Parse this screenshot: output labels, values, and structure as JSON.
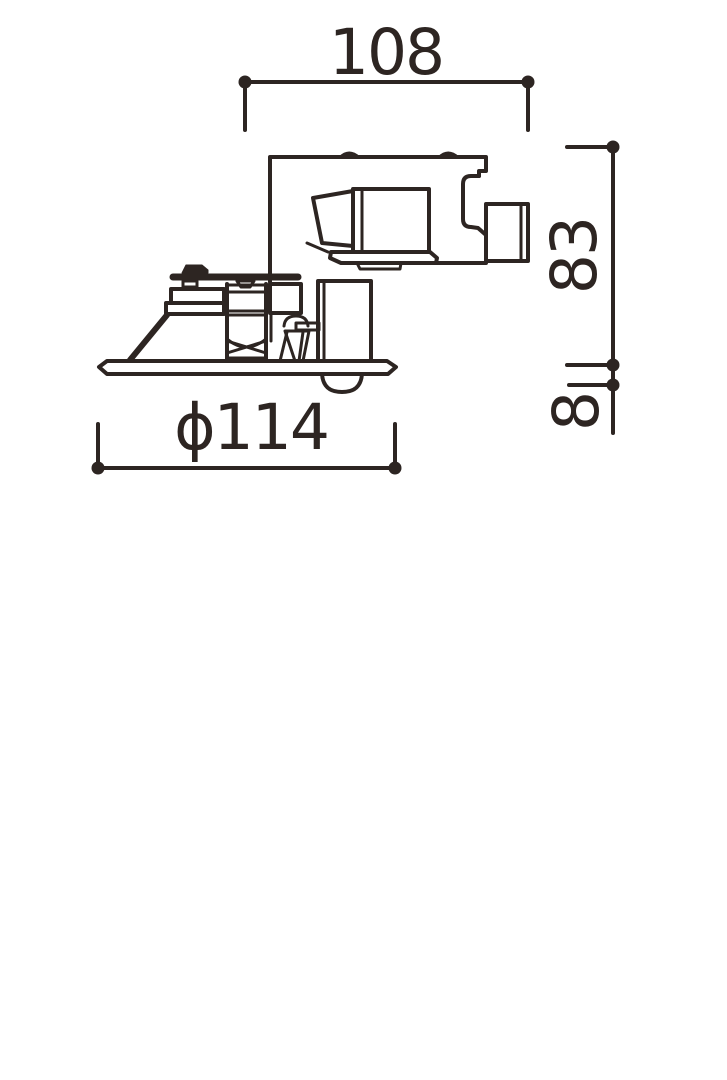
{
  "figure": {
    "type": "technical-dimension-drawing",
    "subject": "recessed downlight fixture side view",
    "ink_color": "#2d2522",
    "background_color": "#ffffff"
  },
  "dimensions": {
    "width_top": {
      "label": "108",
      "orientation": "horizontal"
    },
    "height_right": {
      "label": "83",
      "orientation": "vertical-rotated"
    },
    "flange_right": {
      "label": "8",
      "orientation": "vertical-rotated"
    },
    "diameter_bottom": {
      "label": "ϕ114",
      "orientation": "horizontal"
    }
  }
}
